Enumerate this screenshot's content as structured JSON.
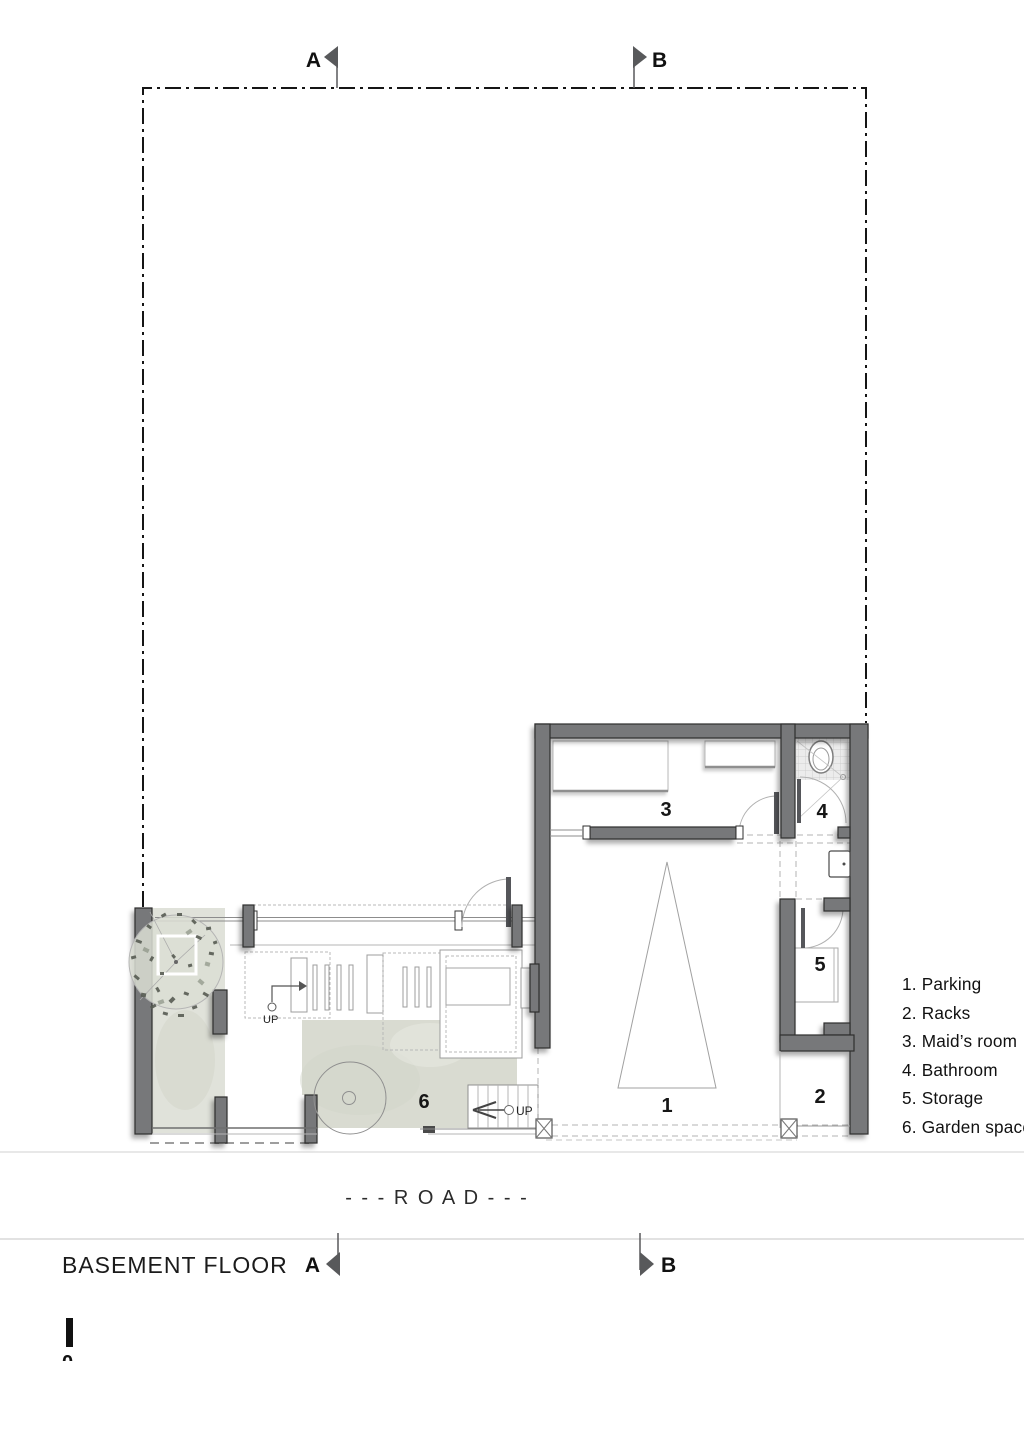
{
  "drawing": {
    "title": "BASEMENT FLOOR",
    "road_label": "- - - R O A D - - -",
    "section_markers": {
      "a": "A",
      "b": "B"
    },
    "scale_zero": "0",
    "up_label": "UP"
  },
  "rooms": {
    "parking": {
      "number": "1",
      "name": "Parking"
    },
    "racks": {
      "number": "2",
      "name": "Racks"
    },
    "maids_room": {
      "number": "3",
      "name": "Maid’s room"
    },
    "bathroom": {
      "number": "4",
      "name": "Bathroom"
    },
    "storage": {
      "number": "5",
      "name": "Storage"
    },
    "garden": {
      "number": "6",
      "name": "Garden space"
    }
  },
  "legend": {
    "items": [
      {
        "text": "1. Parking"
      },
      {
        "text": "2. Racks"
      },
      {
        "text": "3. Maid’s room"
      },
      {
        "text": "4. Bathroom"
      },
      {
        "text": "5. Storage"
      },
      {
        "text": "6. Garden space"
      }
    ]
  },
  "colors": {
    "wall": "#77787a",
    "wall_edge": "#2f2f2f",
    "floor_wash": "#d9dbd1",
    "garden_wash": "#e0e2da",
    "thin_line": "#8c8c8c",
    "dashed_line": "#b3b3b3",
    "marker_flag": "#58595b",
    "boundary": "#151515",
    "text": "#1a1a1a"
  }
}
